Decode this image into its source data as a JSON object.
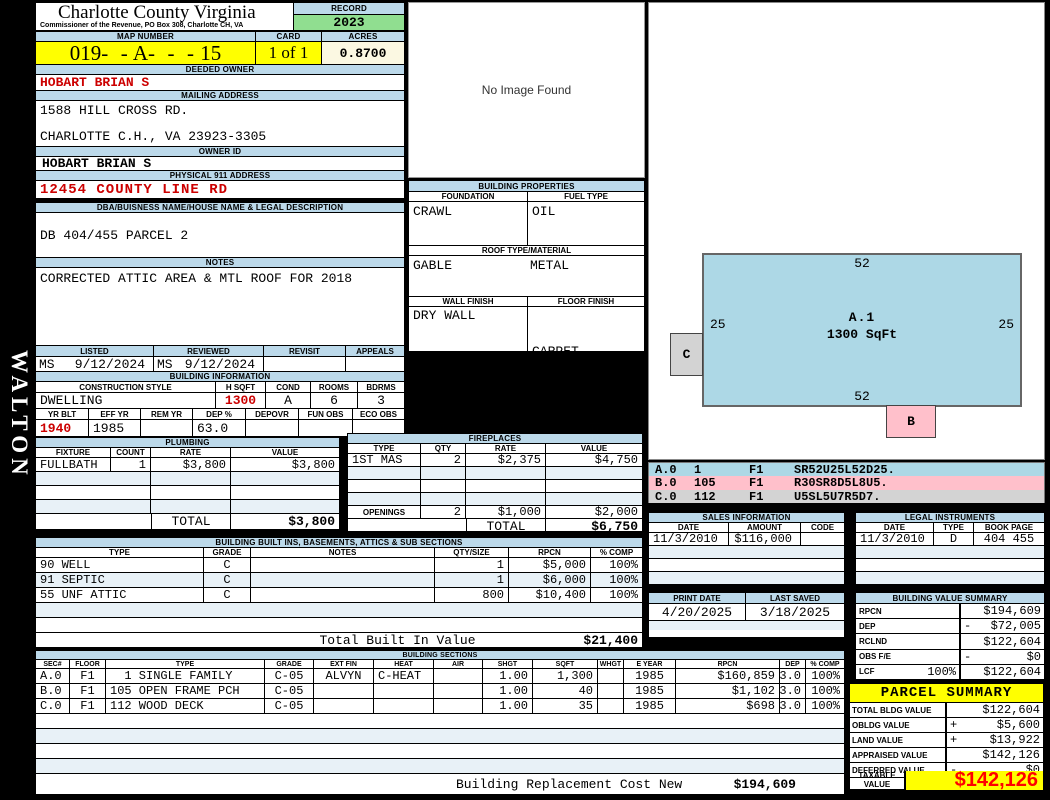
{
  "sidebar_text": "WALTON",
  "header": {
    "title": "Charlotte County Virginia",
    "subtitle": "Commissioner of the Revenue, PO Box 308, Charlotte CH, VA",
    "record_label": "RECORD",
    "record_year": "2023",
    "map_number_label": "MAP NUMBER",
    "map_number": "019-  - A-  -  - 15",
    "card_label": "CARD",
    "card_value": "1 of 1",
    "acres_label": "ACRES",
    "acres_value": "0.8700"
  },
  "owner": {
    "deeded_owner_label": "DEEDED OWNER",
    "deeded_owner": "HOBART BRIAN S",
    "mailing_address_label": "MAILING ADDRESS",
    "mailing_line1": "1588 HILL CROSS RD.",
    "mailing_line2": "CHARLOTTE C.H., VA 23923-3305",
    "owner_id_label": "OWNER ID",
    "owner_id": "HOBART BRIAN S",
    "physical_address_label": "PHYSICAL 911 ADDRESS",
    "physical_address": "12454 COUNTY LINE RD",
    "dba_label": "DBA/BUISNESS NAME/HOUSE NAME & LEGAL DESCRIPTION",
    "dba_value": "DB 404/455 PARCEL 2",
    "notes_label": "NOTES",
    "notes_value": "CORRECTED ATTIC AREA & MTL ROOF FOR 2018"
  },
  "review": {
    "listed_label": "LISTED",
    "reviewed_label": "REVIEWED",
    "revisit_label": "REVISIT",
    "appeals_label": "APPEALS",
    "listed_by": "MS",
    "listed_date": "9/12/2024",
    "reviewed_by": "MS",
    "reviewed_date": "9/12/2024"
  },
  "building_information": {
    "label": "BUILDING INFORMATION",
    "construction_style_label": "CONSTRUCTION STYLE",
    "h_sqft_label": "H SQFT",
    "cond_label": "COND",
    "rooms_label": "ROOMS",
    "bdrms_label": "BDRMS",
    "construction_style": "DWELLING",
    "h_sqft": "1300",
    "cond": "A",
    "rooms": "6",
    "bdrms": "3",
    "yr_blt_label": "YR BLT",
    "eff_yr_label": "EFF YR",
    "rem_yr_label": "REM YR",
    "dep_label": "DEP %",
    "depovr_label": "DEPOVR",
    "fun_obs_label": "FUN OBS",
    "eco_obs_label": "ECO OBS",
    "yr_blt": "1940",
    "eff_yr": "1985",
    "dep_pct": "63.0"
  },
  "plumbing": {
    "label": "PLUMBING",
    "headers": [
      "FIXTURE",
      "COUNT",
      "RATE",
      "VALUE"
    ],
    "row": [
      "FULLBATH",
      "1",
      "$3,800",
      "$3,800"
    ],
    "total_label": "TOTAL",
    "total_value": "$3,800"
  },
  "fireplaces": {
    "label": "FIREPLACES",
    "headers": [
      "TYPE",
      "QTY",
      "RATE",
      "VALUE"
    ],
    "row": [
      "1ST MAS",
      "2",
      "$2,375",
      "$4,750"
    ],
    "openings": [
      "OPENINGS",
      "2",
      "$1,000",
      "$2,000"
    ],
    "total_label": "TOTAL",
    "total_value": "$6,750"
  },
  "built_ins": {
    "label": "BUILDING BUILT INS, BASEMENTS, ATTICS & SUB SECTIONS",
    "headers": [
      "TYPE",
      "GRADE",
      "NOTES",
      "QTY/SIZE",
      "RPCN",
      "% COMP"
    ],
    "rows": [
      [
        "90 WELL",
        "C",
        "",
        "1",
        "$5,000",
        "100%"
      ],
      [
        "91 SEPTIC",
        "C",
        "",
        "1",
        "$6,000",
        "100%"
      ],
      [
        "55 UNF ATTIC",
        "C",
        "",
        "800",
        "$10,400",
        "100%"
      ]
    ],
    "total_label": "Total Built In Value",
    "total_value": "$21,400"
  },
  "building_sections": {
    "label": "BUILDING SECTIONS",
    "headers": [
      "SEC#",
      "FLOOR",
      "TYPE",
      "GRADE",
      "EXT FIN",
      "HEAT",
      "AIR",
      "SHGT",
      "SQFT",
      "WHGT",
      "E YEAR",
      "RPCN",
      "DEP",
      "% COMP"
    ],
    "rows": [
      [
        "A.0",
        "F1",
        "  1 SINGLE FAMILY",
        "C-05",
        "ALVYN",
        "C-HEAT",
        "",
        "1.00",
        "1,300",
        "",
        "1985",
        "$160,859",
        "63.0",
        "100%"
      ],
      [
        "B.0",
        "F1",
        "105 OPEN FRAME PCH",
        "C-05",
        "",
        "",
        "",
        "1.00",
        "40",
        "",
        "1985",
        "$1,102",
        "63.0",
        "100%"
      ],
      [
        "C.0",
        "F1",
        "112 WOOD DECK",
        "C-05",
        "",
        "",
        "",
        "1.00",
        "35",
        "",
        "1985",
        "$698",
        "63.0",
        "100%"
      ]
    ],
    "footer_label": "Building Replacement Cost New",
    "footer_value": "$194,609"
  },
  "image_panel": {
    "no_image_text": "No Image Found"
  },
  "building_properties": {
    "label": "BUILDING PROPERTIES",
    "foundation_label": "FOUNDATION",
    "fuel_type_label": "FUEL TYPE",
    "foundation": "CRAWL",
    "fuel_type": "OIL",
    "roof_label": "ROOF TYPE/MATERIAL",
    "roof_type": "GABLE",
    "roof_material": "METAL",
    "wall_finish_label": "WALL FINISH",
    "floor_finish_label": "FLOOR FINISH",
    "wall_finish": "DRY WALL",
    "floor_finish_1": "CARPET",
    "floor_finish_2": "TILE",
    "floor_finish_3": "HARDWOOD"
  },
  "sketch": {
    "area_label": "A.1",
    "area_sqft": "1300 SqFt",
    "dim_top": "52",
    "dim_bottom": "52",
    "dim_left": "25",
    "dim_right": "25",
    "box_c": "C",
    "box_b": "B",
    "legend": [
      {
        "sec": "A.0",
        "code": "1",
        "floor": "F1",
        "trace": "SR52U25L52D25."
      },
      {
        "sec": "B.0",
        "code": "105",
        "floor": "F1",
        "trace": "R30SR8D5L8U5."
      },
      {
        "sec": "C.0",
        "code": "112",
        "floor": "F1",
        "trace": "U5SL5U7R5D7."
      }
    ]
  },
  "sales": {
    "label": "SALES INFORMATION",
    "headers": [
      "DATE",
      "AMOUNT",
      "CODE"
    ],
    "row": {
      "date": "11/3/2010",
      "amount": "$116,000",
      "code": ""
    }
  },
  "legal": {
    "label": "LEGAL INSTRUMENTS",
    "headers": [
      "DATE",
      "TYPE",
      "BOOK PAGE"
    ],
    "row": {
      "date": "11/3/2010",
      "type": "D",
      "book_page": "404 455"
    }
  },
  "dates": {
    "print_date_label": "PRINT DATE",
    "print_date": "4/20/2025",
    "last_saved_label": "LAST SAVED",
    "last_saved": "3/18/2025"
  },
  "building_value_summary": {
    "label": "BUILDING VALUE SUMMARY",
    "rows": [
      {
        "name": "RPCN",
        "pct": "",
        "op": "",
        "value": "$194,609"
      },
      {
        "name": "DEP",
        "pct": "",
        "op": "-",
        "value": "$72,005"
      },
      {
        "name": "RCLND",
        "pct": "",
        "op": "",
        "value": "$122,604"
      },
      {
        "name": "OBS F/E",
        "pct": "",
        "op": "-",
        "value": "$0"
      },
      {
        "name": "LCF",
        "pct": "100%",
        "op": "",
        "value": "$122,604"
      }
    ]
  },
  "parcel_summary": {
    "label": "PARCEL SUMMARY",
    "rows": [
      {
        "name": "TOTAL BLDG VALUE",
        "op": "",
        "value": "$122,604"
      },
      {
        "name": "OBLDG VALUE",
        "op": "+",
        "value": "$5,600"
      },
      {
        "name": "LAND VALUE",
        "op": "+",
        "value": "$13,922"
      },
      {
        "name": "APPRAISED VALUE",
        "op": "",
        "value": "$142,126"
      },
      {
        "name": "DEFERRED VALUE",
        "op": "-",
        "value": "$0"
      }
    ],
    "taxable_label": "TAXABLE VALUE",
    "taxable_value": "$142,126"
  },
  "colors": {
    "section_bar": "#BCD9EA",
    "row_stripe": "#E8F1F7",
    "highlight_yellow": "#FFFF00",
    "record_green": "#90DE90",
    "acres_ivory": "#FBF8E2",
    "red_text": "#CC0000",
    "taxable_red": "#FF0000",
    "sketch_blue": "#ADD8E6",
    "sketch_pink": "#FFC0CB",
    "sketch_gray": "#D3D3D3"
  }
}
